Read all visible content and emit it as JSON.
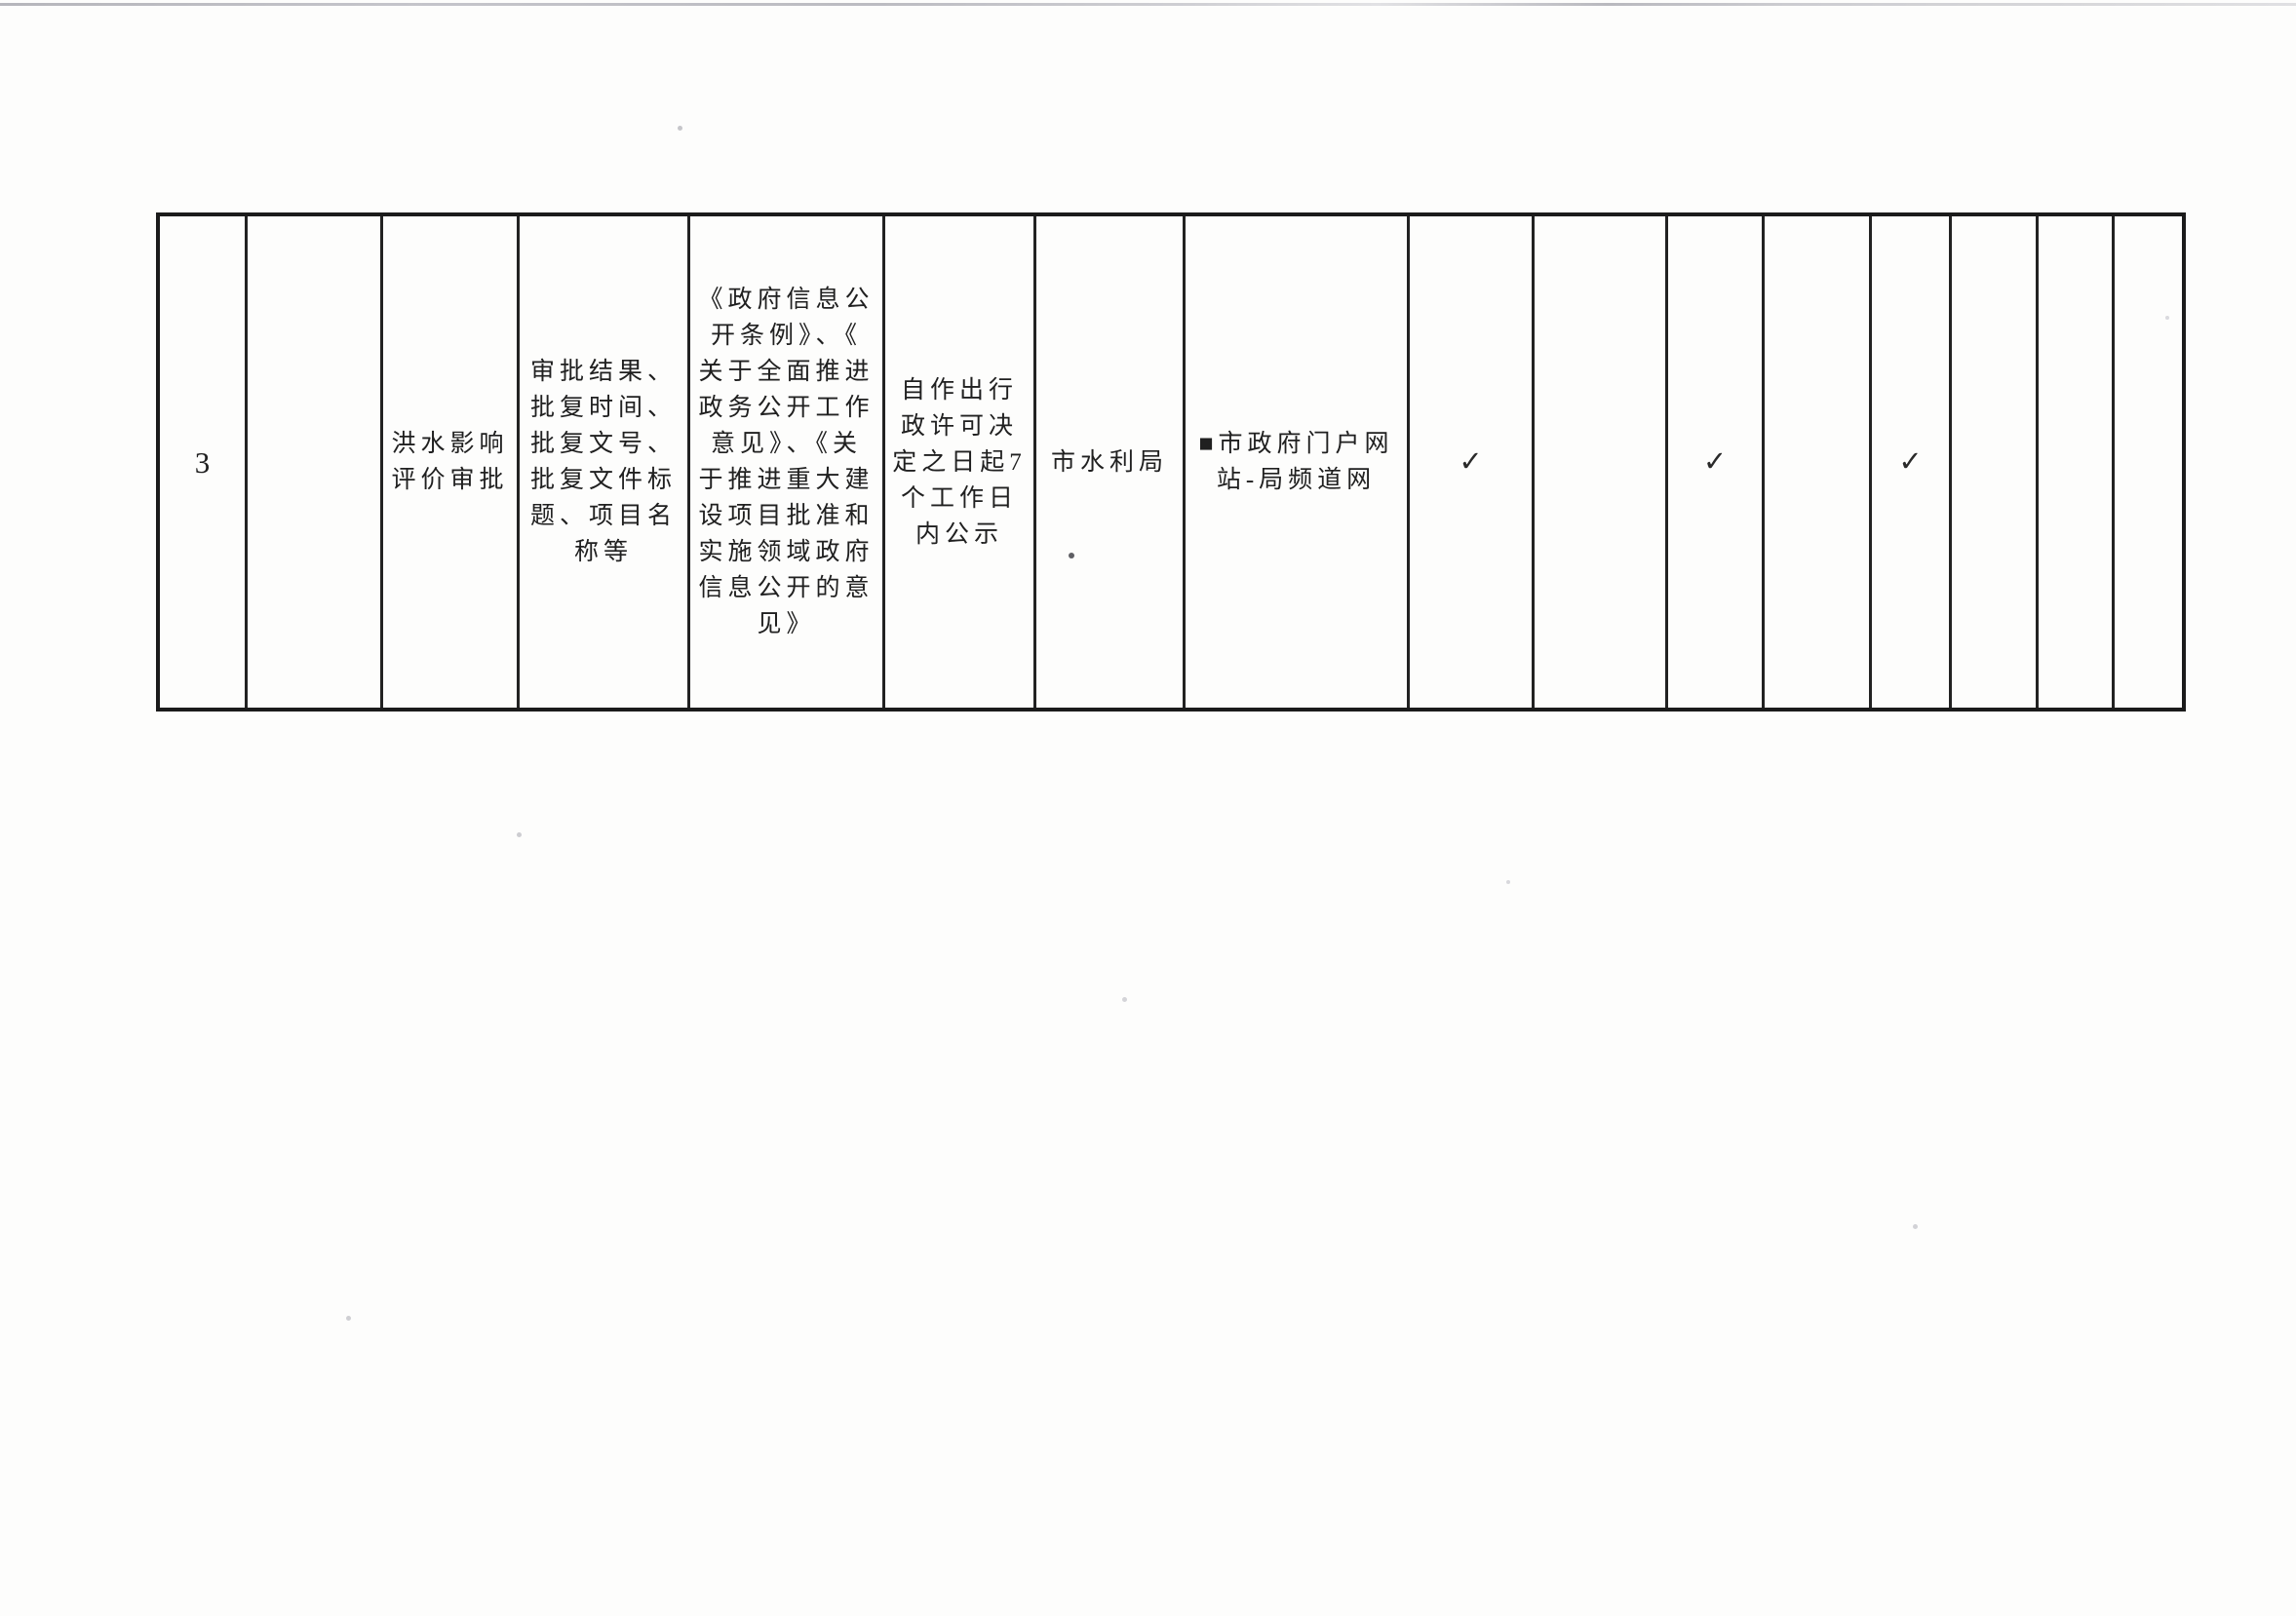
{
  "page": {
    "kind": "scanned document table row",
    "background": "#fdfdfc",
    "ink": "#202020",
    "border": "#1b1b1b"
  },
  "table": {
    "cells": [
      {
        "name": "row-number",
        "text": "3"
      },
      {
        "name": "blank-category",
        "text": ""
      },
      {
        "name": "item-name",
        "text": "洪水影响\n评价审批"
      },
      {
        "name": "disclosure-content",
        "text": "审批结果、\n批复时间、\n批复文号、\n批复文件标\n题、项目名\n称等"
      },
      {
        "name": "disclosure-basis",
        "text": "《政府信息公\n开条例》、《\n关于全面推进\n政务公开工作\n意见》、《关\n于推进重大建\n设项目批准和\n实施领域政府\n信息公开的意\n见》"
      },
      {
        "name": "disclosure-deadline",
        "text": "自作出行\n政许可决\n定之日起7\n个工作日\n内公示"
      },
      {
        "name": "responsible-unit",
        "text": "市水利局"
      },
      {
        "name": "disclosure-channel",
        "text": "■市政府门户网\n站-局频道网"
      },
      {
        "name": "checkmark-1",
        "text": "✓"
      },
      {
        "name": "blank-1",
        "text": ""
      },
      {
        "name": "checkmark-2",
        "text": "✓"
      },
      {
        "name": "blank-2",
        "text": ""
      },
      {
        "name": "checkmark-3",
        "text": "✓"
      },
      {
        "name": "blank-3",
        "text": ""
      },
      {
        "name": "blank-4",
        "text": ""
      },
      {
        "name": "blank-5",
        "text": ""
      }
    ]
  }
}
